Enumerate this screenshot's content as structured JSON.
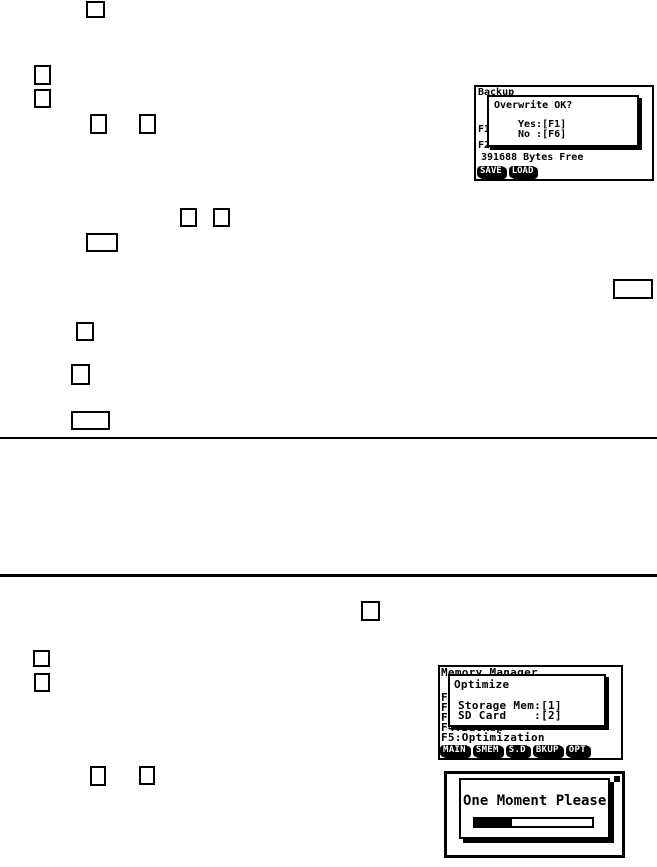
{
  "colors": {
    "ink": "#000000",
    "paper": "#ffffff"
  },
  "screens": {
    "backup": {
      "header": "Backup",
      "dialog": {
        "title": "Overwrite OK?",
        "yes": "Yes:[F1]",
        "no": "No :[F6]"
      },
      "row_f1": "F1",
      "row_f2": "F2:Load Backup Data",
      "bytes_free": "391688 Bytes Free",
      "fkeys": [
        "SAVE",
        "LOAD"
      ]
    },
    "memory_manager": {
      "header": "Memory Manager",
      "dialog": {
        "title": "Optimize",
        "option1": "Storage Mem:[1]",
        "option2": "SD Card    :[2]"
      },
      "rows": [
        "F1",
        "F2",
        "F3",
        "F4:Backup",
        "F5:Optimization"
      ],
      "fkeys": [
        "MAIN",
        "SMEM",
        "S.D",
        "BKUP",
        "OPT"
      ]
    },
    "one_moment": {
      "message": "One Moment Please",
      "progress_percent": 32
    }
  }
}
